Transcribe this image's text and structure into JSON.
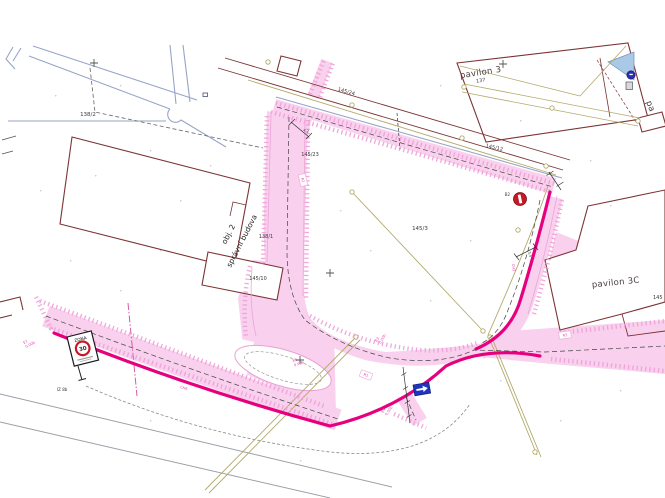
{
  "colors": {
    "background": "#ffffff",
    "road_fill_pink": "#f9d0ed",
    "road_hatch_pink": "#ef9fd7",
    "road_edge_magenta": "#e6007e",
    "existing_road_blue": "#96a5c6",
    "building_outline_maroon": "#7c3434",
    "utility_line_olive": "#b2a96a",
    "annotation_pink": "#e23fa8",
    "sign_red": "#c51a25",
    "sign_blue": "#1f35c0",
    "roof_fill_blue": "#a9c9e6",
    "text_dark": "#3a3a3a"
  },
  "parcels": {
    "p138_2": "138/2",
    "p145_24": "145/24",
    "p145_23": "145/23",
    "p145_12": "145/12",
    "p137": "137",
    "p138_1": "138/1",
    "p145_10": "145/10",
    "p145_3": "145/3",
    "p145_part": "145"
  },
  "buildings": {
    "pavilon3": "pavilon 3",
    "pavilon3c": "pavilon 3C",
    "obj2_line1": "obj. 2",
    "obj2_line2": "správní budova",
    "pavilon_partial": "pa"
  },
  "traffic_signs": {
    "zone_sign": {
      "title": "ZONA",
      "speed": "30",
      "code": "IZ 8b"
    },
    "no_entry_sign": {
      "code": "B2"
    }
  },
  "ref_badges": {
    "r1": "R1",
    "r2": "R2",
    "r3": "R3"
  },
  "annotations": {
    "e1_line1": "E1",
    "e1_line2": "0.00b",
    "e2_line1": "E2",
    "e2_line2": "0.00b",
    "e3_line1": "E3",
    "e3_line2": "0.00b",
    "e4_line1": "E4",
    "e4_line2": "0.00b",
    "ch3": "CH3",
    "ch6": "CH6",
    "dim_a": "4,2",
    "dim_b": "3,5"
  }
}
